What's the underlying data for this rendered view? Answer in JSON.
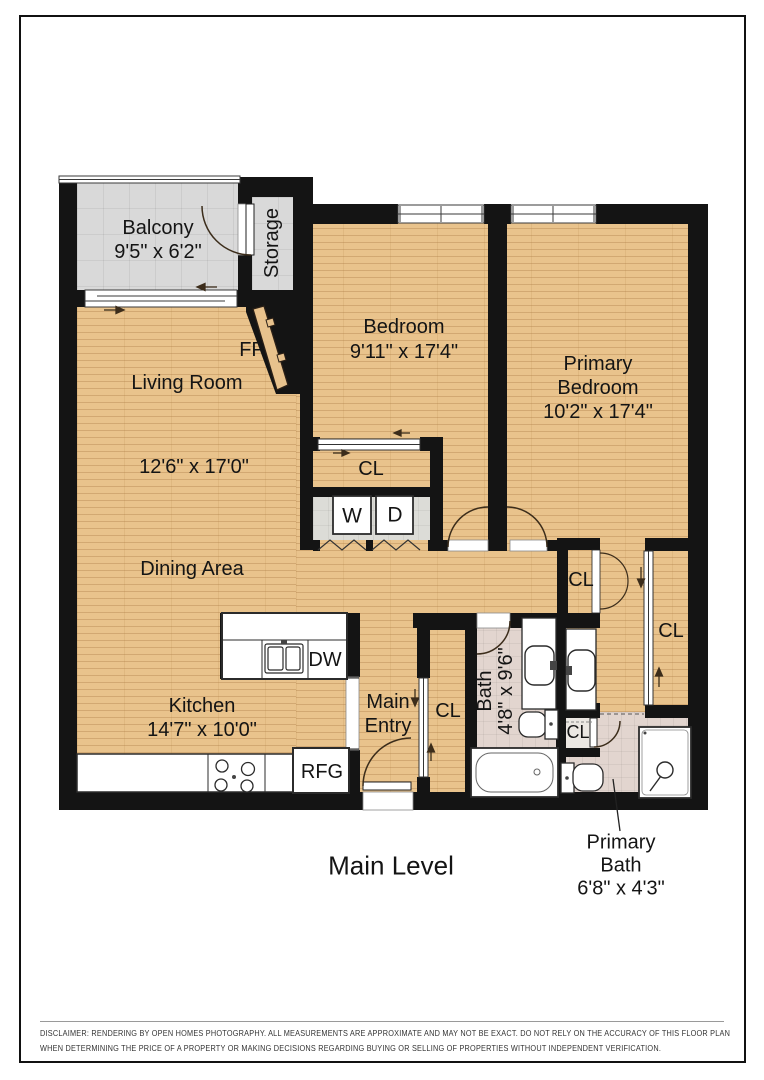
{
  "page": {
    "title": "Main Level",
    "disclaimer": {
      "line1": "DISCLAIMER: RENDERING BY OPEN HOMES PHOTOGRAPHY. ALL MEASUREMENTS ARE APPROXIMATE AND MAY NOT BE EXACT. DO NOT RELY ON THE ACCURACY OF THIS FLOOR PLAN",
      "line2": "WHEN DETERMINING THE PRICE OF A PROPERTY OR MAKING DECISIONS REGARDING BUYING OR SELLING OF PROPERTIES WITHOUT INDEPENDENT VERIFICATION."
    }
  },
  "rooms": {
    "balcony": {
      "name": "Balcony",
      "dims": "9'5\" x 6'2\""
    },
    "storage": {
      "name": "Storage"
    },
    "living_room": {
      "name": "Living Room",
      "dims": "12'6\" x 17'0\""
    },
    "dining_area": {
      "name": "Dining Area"
    },
    "bedroom": {
      "name": "Bedroom",
      "dims": "9'11\" x 17'4\""
    },
    "primary_bedroom": {
      "line1": "Primary",
      "line2": "Bedroom",
      "dims": "10'2\" x 17'4\""
    },
    "kitchen": {
      "name": "Kitchen",
      "dims": "14'7\" x 10'0\""
    },
    "main_entry": {
      "line1": "Main",
      "line2": "Entry"
    },
    "bath": {
      "name": "Bath",
      "dims": "4'8\" x 9'6\""
    },
    "primary_bath": {
      "line1": "Primary",
      "line2": "Bath",
      "dims": "6'8\" x 4'3\""
    }
  },
  "fixtures": {
    "fireplace": "FP",
    "closet": "CL",
    "washer": "W",
    "dryer": "D",
    "dishwasher": "DW",
    "refrigerator": "RFG"
  },
  "colors": {
    "wall": "#141414",
    "wood_floor": "#e9c38c",
    "balcony_tile": "#d9d9d9",
    "bath_tile": "#e2d5cf",
    "page_background": "#ffffff"
  }
}
